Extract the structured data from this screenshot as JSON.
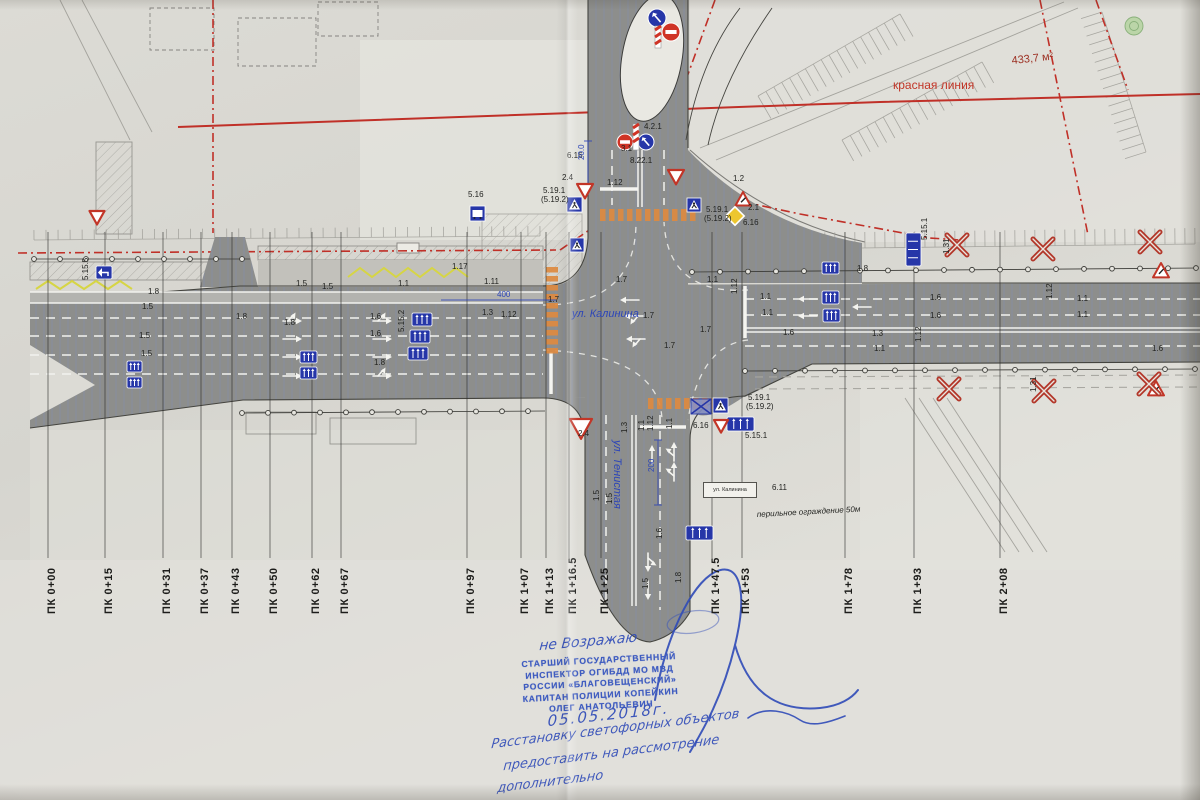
{
  "colors": {
    "ink": "#222320",
    "blue": "#2c45b8",
    "sign_blue": "#2636a8",
    "red": "#c23527",
    "dark_red": "#9c2f22",
    "orange": "#dd8a40",
    "yellow": "#d6d544",
    "road": "#8d8e8c",
    "paper": "#dcdad4",
    "stamp_blue": "#3f5cc0",
    "pen_blue": "#2f4bb8"
  },
  "stations": [
    {
      "label": "ПК 0+00",
      "x": 48
    },
    {
      "label": "ПК 0+15",
      "x": 105
    },
    {
      "label": "ПК 0+31",
      "x": 163
    },
    {
      "label": "ПК 0+37",
      "x": 201
    },
    {
      "label": "ПК 0+43",
      "x": 232
    },
    {
      "label": "ПК 0+50",
      "x": 270
    },
    {
      "label": "ПК 0+62",
      "x": 312
    },
    {
      "label": "ПК 0+67",
      "x": 341
    },
    {
      "label": "ПК 0+97",
      "x": 467
    },
    {
      "label": "ПК 1+07",
      "x": 521
    },
    {
      "label": "ПК 1+13",
      "x": 546
    },
    {
      "label": "ПК 1+16.5",
      "x": 569
    },
    {
      "label": "ПК 1+25",
      "x": 601
    },
    {
      "label": "ПК 1+47.5",
      "x": 712
    },
    {
      "label": "ПК 1+53",
      "x": 742
    },
    {
      "label": "ПК 1+78",
      "x": 845
    },
    {
      "label": "ПК 1+93",
      "x": 914
    },
    {
      "label": "ПК 2+08",
      "x": 1000
    }
  ],
  "streets": {
    "kalinina": "ул. Калинина",
    "tenistaya": "ул. Тенистая"
  },
  "plate": {
    "text": "ул. Калинина",
    "code": "6.11"
  },
  "red_line_label": "красная линия",
  "area_note": "433,7 м²",
  "fence_note": "перильное ограждение 50м",
  "stamp": {
    "handwritten_top": "не Возражаю",
    "lines": [
      "СТАРШИЙ ГОСУДАРСТВЕННЫЙ",
      "ИНСПЕКТОР ОГИБДД МО МВД",
      "РОССИИ «БЛАГОВЕЩЕНСКИЙ»",
      "КАПИТАН ПОЛИЦИИ КОПЕЙКИН",
      "ОЛЕГ АНАТОЛЬЕВИЧ"
    ],
    "date": "05.05.2018г."
  },
  "note": {
    "lines": [
      "Расстановку светофорных объектов",
      "предоставить на рассмотрение",
      "дополнительно"
    ]
  },
  "annotations": [
    {
      "t": "1.8",
      "x": 148,
      "y": 294
    },
    {
      "t": "1.5",
      "x": 142,
      "y": 309
    },
    {
      "t": "1.5",
      "x": 139,
      "y": 338
    },
    {
      "t": "1.5",
      "x": 141,
      "y": 356
    },
    {
      "t": "1.8",
      "x": 236,
      "y": 319
    },
    {
      "t": "1.5",
      "x": 296,
      "y": 286
    },
    {
      "t": "1.5",
      "x": 322,
      "y": 289
    },
    {
      "t": "1.1",
      "x": 398,
      "y": 286
    },
    {
      "t": "1.17",
      "x": 452,
      "y": 269
    },
    {
      "t": "1.11",
      "x": 484,
      "y": 284
    },
    {
      "t": "1.6",
      "x": 370,
      "y": 319
    },
    {
      "t": "1.6",
      "x": 370,
      "y": 336
    },
    {
      "t": "1.8",
      "x": 284,
      "y": 325
    },
    {
      "t": "1.8",
      "x": 374,
      "y": 365
    },
    {
      "t": "1.3",
      "x": 482,
      "y": 315
    },
    {
      "t": "1.12",
      "x": 501,
      "y": 317
    },
    {
      "t": "1.7",
      "x": 548,
      "y": 302
    },
    {
      "t": "1.7",
      "x": 643,
      "y": 318
    },
    {
      "t": "1.7",
      "x": 664,
      "y": 348
    },
    {
      "t": "1.7",
      "x": 616,
      "y": 282
    },
    {
      "t": "1.7",
      "x": 700,
      "y": 332
    },
    {
      "t": "1.12",
      "x": 607,
      "y": 185
    },
    {
      "t": "2.4",
      "x": 562,
      "y": 180
    },
    {
      "t": "6.16",
      "x": 567,
      "y": 158
    },
    {
      "t": "5.16",
      "x": 468,
      "y": 197
    },
    {
      "t": "5.19.1",
      "x": 543,
      "y": 193
    },
    {
      "t": "(5.19.2)",
      "x": 541,
      "y": 202
    },
    {
      "t": "4.2.1",
      "x": 644,
      "y": 129
    },
    {
      "t": "3.1",
      "x": 621,
      "y": 151
    },
    {
      "t": "8.22.1",
      "x": 630,
      "y": 163
    },
    {
      "t": "20.0",
      "x": 584,
      "y": 160,
      "r": -90,
      "c": "b"
    },
    {
      "t": "1.12",
      "x": 653,
      "y": 431,
      "r": -90
    },
    {
      "t": "1.3",
      "x": 627,
      "y": 433,
      "r": -90
    },
    {
      "t": "1.1",
      "x": 644,
      "y": 431,
      "r": -90
    },
    {
      "t": "1.1",
      "x": 672,
      "y": 429,
      "r": -90
    },
    {
      "t": "2.4",
      "x": 578,
      "y": 436
    },
    {
      "t": "200",
      "x": 654,
      "y": 472,
      "r": -90,
      "c": "b"
    },
    {
      "t": "1.5",
      "x": 599,
      "y": 501,
      "r": -90
    },
    {
      "t": "1.5",
      "x": 612,
      "y": 504,
      "r": -90
    },
    {
      "t": "1.6",
      "x": 662,
      "y": 539,
      "r": -90
    },
    {
      "t": "1.8",
      "x": 681,
      "y": 583,
      "r": -90
    },
    {
      "t": "1.5",
      "x": 648,
      "y": 589,
      "r": -90
    },
    {
      "t": "1.2",
      "x": 733,
      "y": 181
    },
    {
      "t": "5.19.1",
      "x": 706,
      "y": 212
    },
    {
      "t": "(5.19.2)",
      "x": 704,
      "y": 221
    },
    {
      "t": "2.1",
      "x": 748,
      "y": 210
    },
    {
      "t": "6.16",
      "x": 743,
      "y": 225
    },
    {
      "t": "1.8",
      "x": 857,
      "y": 271
    },
    {
      "t": "1.1",
      "x": 707,
      "y": 282
    },
    {
      "t": "1.12",
      "x": 737,
      "y": 294,
      "r": -90
    },
    {
      "t": "1.1",
      "x": 760,
      "y": 299
    },
    {
      "t": "1.1",
      "x": 762,
      "y": 315
    },
    {
      "t": "1.6",
      "x": 930,
      "y": 300
    },
    {
      "t": "1.6",
      "x": 930,
      "y": 318
    },
    {
      "t": "1.3",
      "x": 872,
      "y": 336
    },
    {
      "t": "1.1",
      "x": 874,
      "y": 351
    },
    {
      "t": "1.12",
      "x": 921,
      "y": 342,
      "r": -90
    },
    {
      "t": "1.6",
      "x": 783,
      "y": 335
    },
    {
      "t": "1.12",
      "x": 1052,
      "y": 299,
      "r": -90
    },
    {
      "t": "1.1",
      "x": 1077,
      "y": 301
    },
    {
      "t": "1.1",
      "x": 1077,
      "y": 317
    },
    {
      "t": "1.6",
      "x": 1152,
      "y": 351
    },
    {
      "t": "400",
      "x": 497,
      "y": 297,
      "c": "b"
    },
    {
      "t": "5.15.1",
      "x": 745,
      "y": 438
    },
    {
      "t": "5.15.2",
      "x": 404,
      "y": 332,
      "r": -90
    },
    {
      "t": "5.15.1",
      "x": 927,
      "y": 240,
      "r": -90
    },
    {
      "t": "5.15.5",
      "x": 88,
      "y": 280,
      "r": -90
    },
    {
      "t": "6.16",
      "x": 693,
      "y": 428
    },
    {
      "t": "5.19.1",
      "x": 748,
      "y": 400
    },
    {
      "t": "(5.19.2)",
      "x": 746,
      "y": 409
    },
    {
      "t": "6.11",
      "x": 772,
      "y": 490
    },
    {
      "t": "1.31",
      "x": 949,
      "y": 254,
      "r": -90
    },
    {
      "t": "1.31",
      "x": 1036,
      "y": 392,
      "r": -90
    },
    {
      "t": "ул. Калинина",
      "x": 572,
      "y": 317,
      "c": "b",
      "s": 11,
      "i": 1
    },
    {
      "t": "ул. Тенистая",
      "x": 614,
      "y": 440,
      "r": 90,
      "c": "b",
      "s": 11,
      "i": 1
    },
    {
      "t": "красная линия",
      "x": 893,
      "y": 89,
      "c": "r",
      "s": 12
    },
    {
      "t": "433,7 м²",
      "x": 1012,
      "y": 64,
      "c": "d",
      "s": 11,
      "r": -6
    },
    {
      "t": "перильное ограждение 50м",
      "x": 757,
      "y": 517,
      "c": "k",
      "s": 8,
      "i": 1,
      "r": -3
    }
  ],
  "signs": [
    {
      "k": "lane",
      "x": 300,
      "y": 351,
      "w": 17,
      "h": 12
    },
    {
      "k": "lane",
      "x": 300,
      "y": 367,
      "w": 17,
      "h": 12
    },
    {
      "k": "lane",
      "x": 412,
      "y": 313,
      "w": 20,
      "h": 13
    },
    {
      "k": "lane",
      "x": 410,
      "y": 330,
      "w": 20,
      "h": 13
    },
    {
      "k": "lane",
      "x": 408,
      "y": 347,
      "w": 20,
      "h": 13
    },
    {
      "k": "lane",
      "x": 822,
      "y": 262,
      "w": 17,
      "h": 12
    },
    {
      "k": "lane",
      "x": 822,
      "y": 291,
      "w": 17,
      "h": 13
    },
    {
      "k": "lane",
      "x": 823,
      "y": 309,
      "w": 17,
      "h": 13
    },
    {
      "k": "laneV",
      "x": 906,
      "y": 233,
      "w": 15,
      "h": 33
    },
    {
      "k": "lane",
      "x": 727,
      "y": 417,
      "w": 27,
      "h": 14
    },
    {
      "k": "lane",
      "x": 686,
      "y": 526,
      "w": 27,
      "h": 14
    },
    {
      "k": "lane",
      "x": 127,
      "y": 361,
      "w": 15,
      "h": 11
    },
    {
      "k": "lane",
      "x": 127,
      "y": 377,
      "w": 15,
      "h": 11
    },
    {
      "k": "arrowSign",
      "x": 96,
      "y": 266,
      "w": 16,
      "h": 13
    },
    {
      "k": "crossed",
      "x": 691,
      "y": 399,
      "w": 20,
      "h": 15
    },
    {
      "k": "ped",
      "x": 567,
      "y": 197,
      "s": 15
    },
    {
      "k": "ped",
      "x": 687,
      "y": 198,
      "s": 14
    },
    {
      "k": "ped",
      "x": 713,
      "y": 398,
      "s": 15
    },
    {
      "k": "ped",
      "x": 570,
      "y": 238,
      "s": 14
    },
    {
      "k": "gw",
      "x": 97,
      "y": 211,
      "s": 15
    },
    {
      "k": "gw",
      "x": 585,
      "y": 184,
      "s": 16
    },
    {
      "k": "gw",
      "x": 676,
      "y": 170,
      "s": 16
    },
    {
      "k": "gw",
      "x": 581,
      "y": 419,
      "s": 22
    },
    {
      "k": "gw",
      "x": 721,
      "y": 420,
      "s": 14
    },
    {
      "k": "warn",
      "x": 743,
      "y": 192,
      "s": 15
    },
    {
      "k": "warn",
      "x": 1161,
      "y": 263,
      "s": 16
    },
    {
      "k": "warn",
      "x": 1156,
      "y": 381,
      "s": 16
    },
    {
      "k": "dia",
      "x": 735,
      "y": 216,
      "s": 13
    },
    {
      "k": "ne",
      "x": 671,
      "y": 32,
      "s": 9
    },
    {
      "k": "br",
      "x": 657,
      "y": 18,
      "s": 9
    },
    {
      "k": "pole",
      "x": 655,
      "y": 26,
      "s": 22
    },
    {
      "k": "ne",
      "x": 625,
      "y": 142,
      "s": 8
    },
    {
      "k": "br",
      "x": 646,
      "y": 142,
      "s": 8
    },
    {
      "k": "pole",
      "x": 633,
      "y": 124,
      "s": 26
    },
    {
      "k": "bus",
      "x": 470,
      "y": 206,
      "s": 15
    },
    {
      "k": "x",
      "x": 957,
      "y": 245,
      "s": 20
    },
    {
      "k": "x",
      "x": 1043,
      "y": 249,
      "s": 20
    },
    {
      "k": "x",
      "x": 1150,
      "y": 242,
      "s": 20
    },
    {
      "k": "x",
      "x": 949,
      "y": 389,
      "s": 20
    },
    {
      "k": "x",
      "x": 1044,
      "y": 391,
      "s": 20
    },
    {
      "k": "x",
      "x": 1149,
      "y": 384,
      "s": 20
    }
  ]
}
